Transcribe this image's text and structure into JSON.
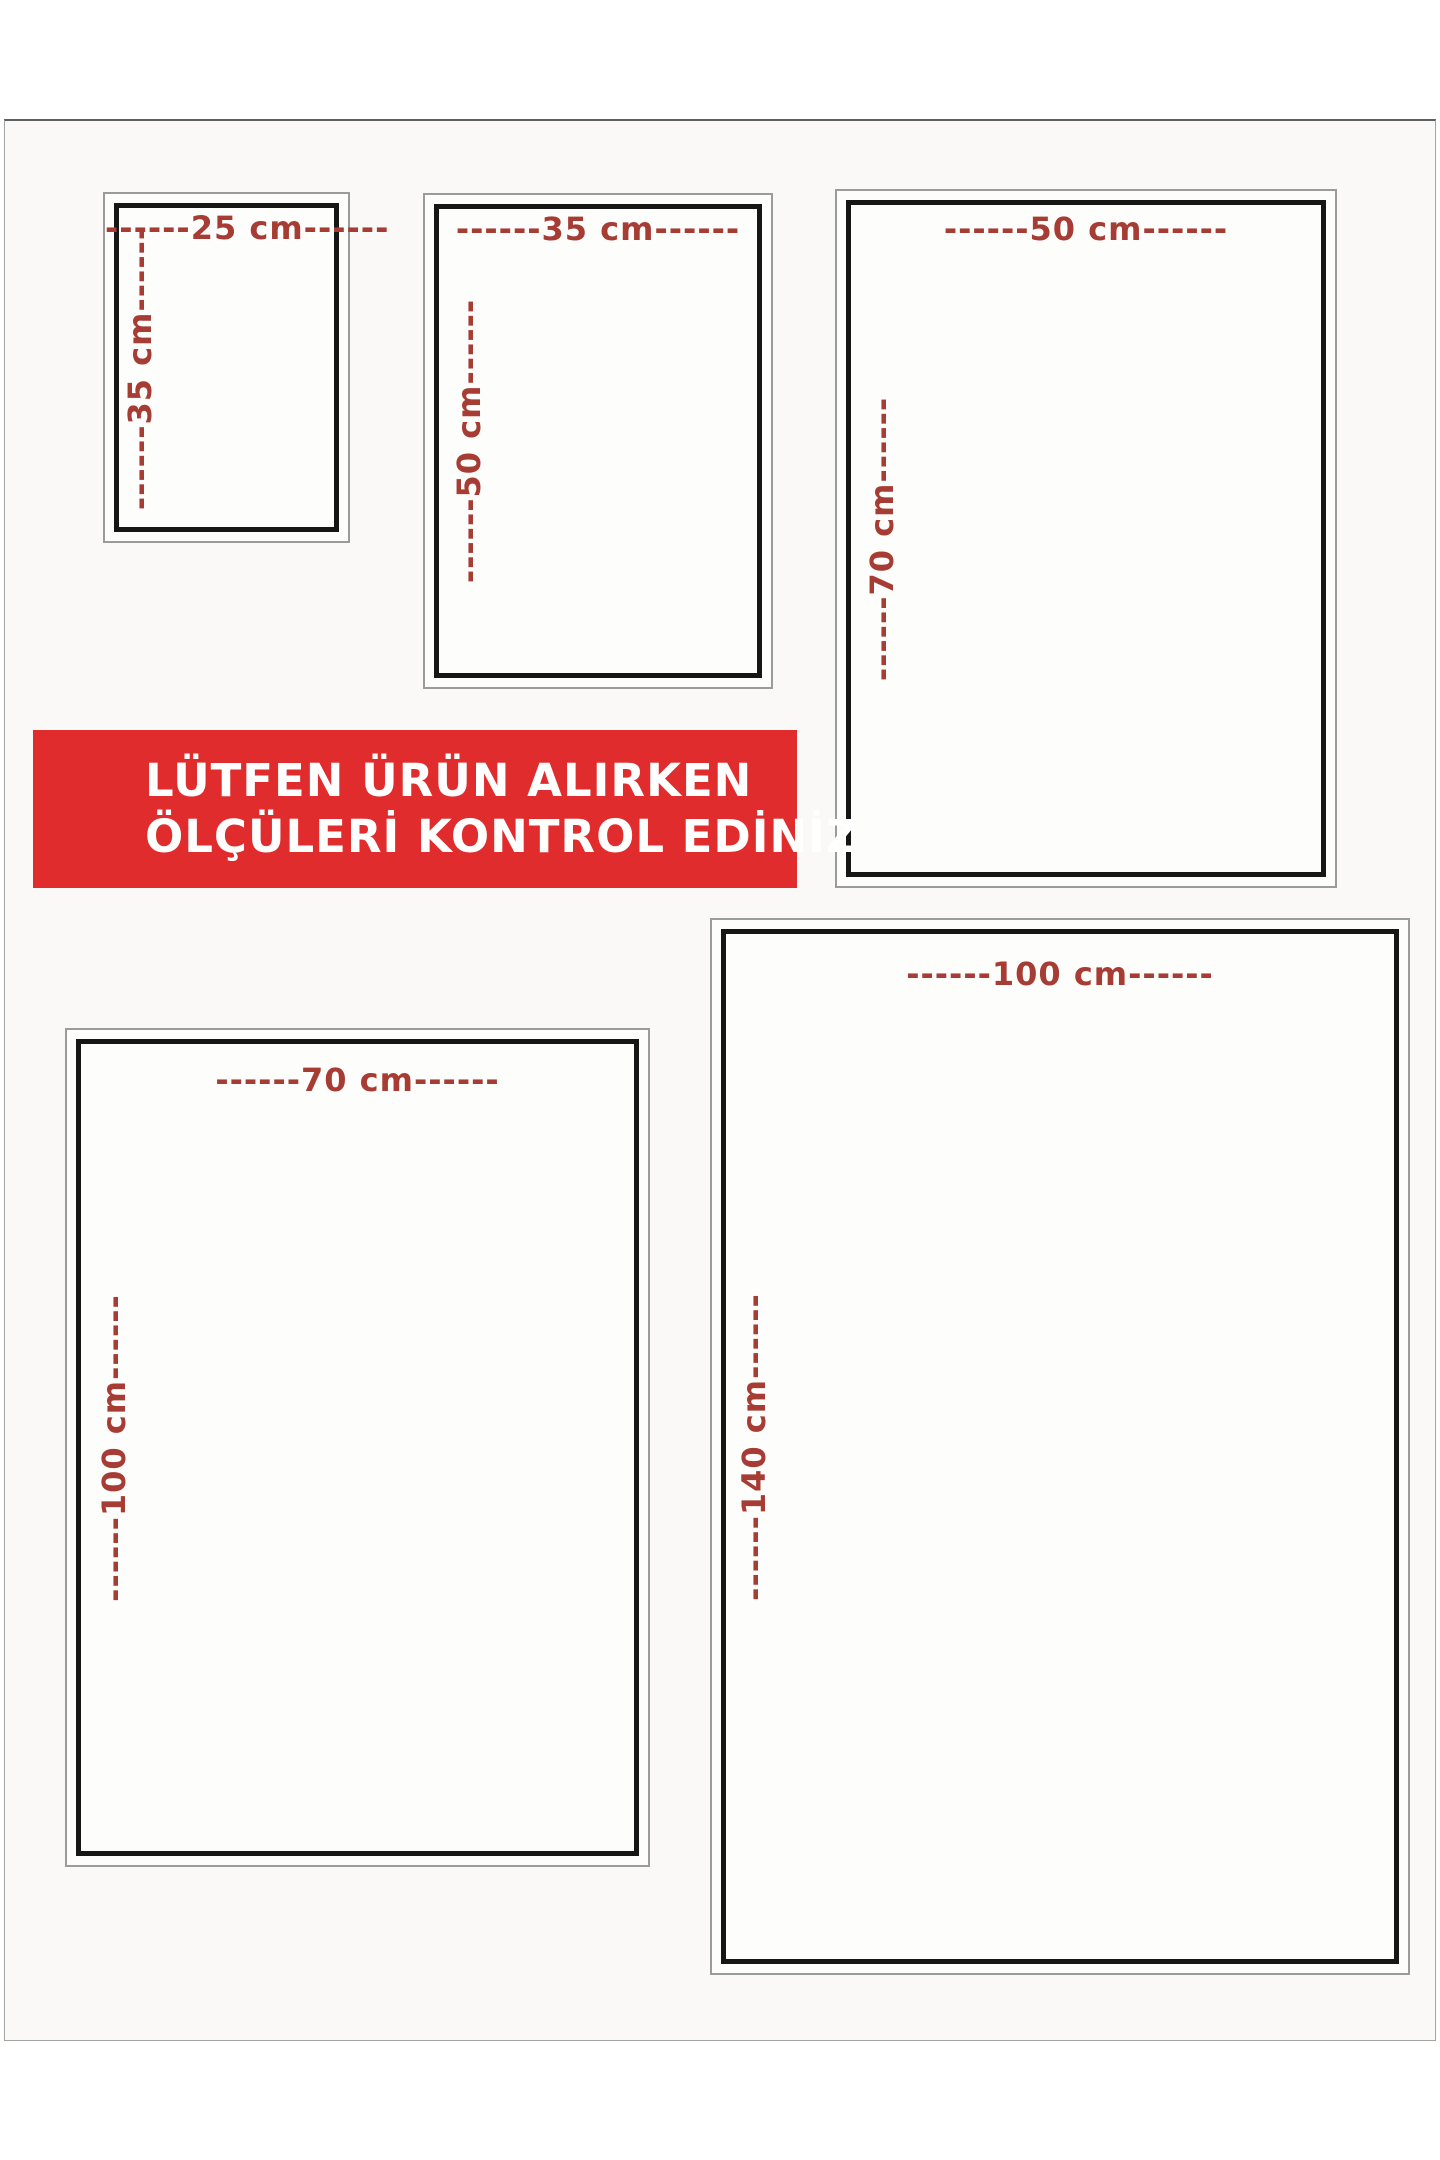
{
  "notice": {
    "line1": "LÜTFEN ÜRÜN ALIRKEN",
    "line2": "ÖLÇÜLERİ KONTROL EDİNİZ"
  },
  "sizes": [
    {
      "name": "25x35",
      "width_cm": 25,
      "height_cm": 35,
      "width_label": "------25 cm------",
      "height_label": "------35 cm------"
    },
    {
      "name": "35x50",
      "width_cm": 35,
      "height_cm": 50,
      "width_label": "------35 cm------",
      "height_label": "------50 cm------"
    },
    {
      "name": "50x70",
      "width_cm": 50,
      "height_cm": 70,
      "width_label": "------50 cm------",
      "height_label": "------70 cm------"
    },
    {
      "name": "70x100",
      "width_cm": 70,
      "height_cm": 100,
      "width_label": "------70 cm------",
      "height_label": "------100 cm------"
    },
    {
      "name": "100x140",
      "width_cm": 100,
      "height_cm": 140,
      "width_label": "------100 cm------",
      "height_label": "------140 cm------"
    }
  ],
  "colors": {
    "banner_bg": "#e02c2c",
    "banner_text": "#ffffff",
    "dimension_text": "#a63c33",
    "box_border": "#161616",
    "frame_border": "#9b9b9b"
  }
}
